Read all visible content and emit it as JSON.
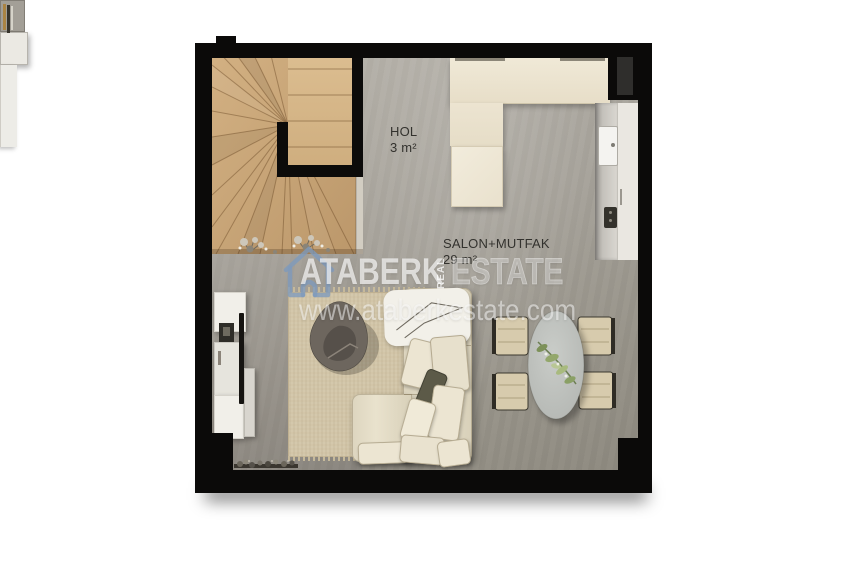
{
  "plan": {
    "rooms": [
      {
        "id": "hol",
        "name": "HOL",
        "area": "3 m²"
      },
      {
        "id": "salon_mutfak",
        "name": "SALON+MUTFAK",
        "area": "29 m²"
      }
    ],
    "furniture": [
      "winder-staircase",
      "kitchen-counter",
      "sink",
      "cooktop",
      "l-shaped-sofa",
      "area-rug",
      "coffee-table",
      "side-tables",
      "tv-unit",
      "oval-dining-table",
      "dining-chairs",
      "wall-console",
      "plant-decor"
    ],
    "colors": {
      "wall": "#0b0a09",
      "floor": "#a19d95",
      "stairs_wood": "#c8a87c",
      "counter": "#ece3cf",
      "sofa": "#e4ddc8",
      "rug": "#d2c5a8",
      "watermark_blue": "#7d9abd"
    }
  },
  "watermark": {
    "brand_first": "ATABERK",
    "brand_vertical": "REAL",
    "brand_last": "ESTATE",
    "website": "www.ataberkestate.com",
    "house_icon": "house-outline-icon"
  }
}
